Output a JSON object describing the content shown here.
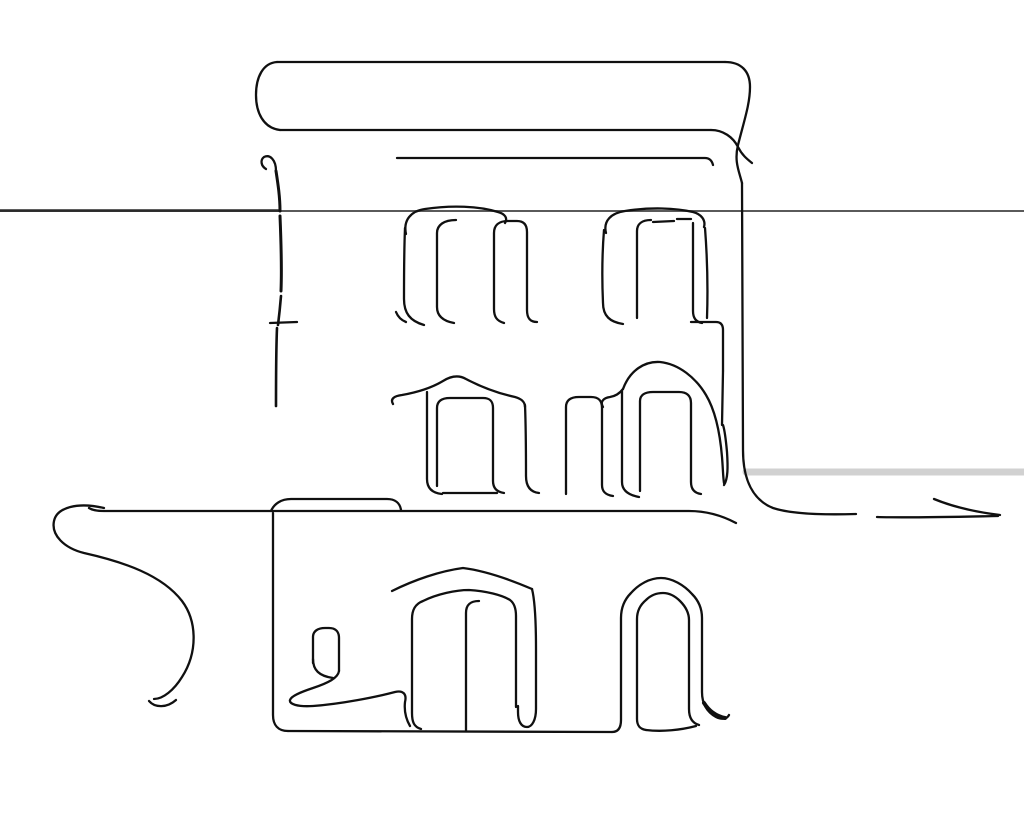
{
  "meta": {
    "subject": "continuous single-line ink sketch of a two-storey classical building with arched windows, a gabled doorway and flourish strokes",
    "background_color": "#ffffff",
    "ink_color": "#101010",
    "default_stroke_width": 2.3,
    "canvas": {
      "width": 1024,
      "height": 819
    }
  },
  "drawing": {
    "viewbox": "0 0 1024 819",
    "paths": [
      {
        "id": "horizon-line-upper",
        "d": "M 0 211 L 1024 211",
        "w": 2,
        "c": "#5a5a5a"
      },
      {
        "id": "horizon-line-upper-left",
        "d": "M 0 210.6 L 278 210.6",
        "w": 2.6,
        "c": "#2a2a2a"
      },
      {
        "id": "shadow-band-right",
        "d": "M 746 472 L 1024 472",
        "w": 7,
        "c": "#000000",
        "o": 0.18
      },
      {
        "id": "roof-top-edge",
        "d": "M 277 62 L 725 62"
      },
      {
        "id": "roof-left-cap",
        "d": "M 277 62 C 263 63 256 77 256 95 C 256 112 263 128 280 130"
      },
      {
        "id": "roof-bottom-edge",
        "d": "M 280 130 L 711 130"
      },
      {
        "id": "roof-right-cap",
        "d": "M 725 62 C 741 62 750 71 750 87 C 750 104 744 121 738 145 C 734 161 739 171 742 183"
      },
      {
        "id": "roof-bottom-right-cross",
        "d": "M 711 130 C 723 130 733 137 738 147 C 742 155 747 159 752 163"
      },
      {
        "id": "fascia-line",
        "d": "M 397 158 L 705 158 C 710 158 712 161 713 165"
      },
      {
        "id": "right-wall",
        "d": "M 742 183 L 743 450 C 743 480 753 500 773 508 C 791 514 822 515 856 514"
      },
      {
        "id": "left-wall-top-curl",
        "d": "M 276 171 C 276 160 270 154 264 157 C 260 160 261 166 266 169"
      },
      {
        "id": "left-wall-dash-1",
        "d": "M 276 171 C 278 184 280 197 280 211",
        "w": 3
      },
      {
        "id": "left-wall-dash-2",
        "d": "M 280 216 C 281 240 282 266 281 291",
        "w": 3
      },
      {
        "id": "left-wall-dash-3",
        "d": "M 281 296 C 280 308 279 317 278 325",
        "w": 2.6
      },
      {
        "id": "left-wall-dash-4",
        "d": "M 277 328 C 276 352 276 378 276 406",
        "w": 2.6
      },
      {
        "id": "left-wall-taper-tip",
        "d": "M 272.5 402 L 279.5 402 L 276 487 Z",
        "fill": true
      },
      {
        "id": "left-wall-sill-tick",
        "d": "M 270 323 L 297 322"
      },
      {
        "id": "win-up-left-arch",
        "d": "M 406 234 C 403 220 411 211 425 209 C 451 205 479 206 498 212 C 505 214 508 218 505 223"
      },
      {
        "id": "win-up-left-side",
        "d": "M 405 228 C 404 252 404 278 404 299 C 404 313 410 321 424 325"
      },
      {
        "id": "win-up-left-tick",
        "d": "M 396 312 C 398 317 401 320 406 322"
      },
      {
        "id": "win-up-left-pane-a",
        "d": "M 456 220 C 444 220 437 225 437 233 L 437 307 C 437 316 443 321 454 323"
      },
      {
        "id": "win-up-left-pane-b",
        "d": "M 504 323 C 497 321 494 317 494 309 L 494 233 C 494 225 499 221 508 221 L 517 221 C 524 221 527 225 527 232 L 527 310 C 527 318 530 322 537 322"
      },
      {
        "id": "win-up-right-arch",
        "d": "M 606 233 C 603 221 611 213 625 211 C 650 207 676 208 693 212 C 701 214 706 220 704 227"
      },
      {
        "id": "win-up-right-side",
        "d": "M 604 230 C 602 255 602 281 603 303 C 603 316 610 322 623 324"
      },
      {
        "id": "win-up-right-jamb",
        "d": "M 705 228 C 707 254 708 289 707 318"
      },
      {
        "id": "win-up-right-sill",
        "d": "M 691 322 L 716 322 C 721 322 723 325 723 330 L 723 371"
      },
      {
        "id": "win-up-right-pane-left",
        "d": "M 637 318 L 637 231 C 637 224 642 220 651 220"
      },
      {
        "id": "win-up-right-pane-top-1",
        "d": "M 653 222 L 674 221"
      },
      {
        "id": "win-up-right-pane-top-2",
        "d": "M 677 219 L 691 219"
      },
      {
        "id": "win-up-right-pane-right",
        "d": "M 693 223 L 693 311 C 693 318 696 322 702 323"
      },
      {
        "id": "win-mid-left-arch",
        "d": "M 393 404 C 390 399 394 396 402 395 C 419 392 433 387 443 381 C 451 376 459 375 466 379 C 485 389 501 394 515 397 C 522 399 525 402 525 407"
      },
      {
        "id": "win-mid-left-side",
        "d": "M 427 392 L 427 479 C 427 488 432 493 442 494"
      },
      {
        "id": "win-mid-left-right-side",
        "d": "M 525 405 C 526 430 526 454 526 476 C 526 486 530 492 539 493"
      },
      {
        "id": "win-mid-left-pane",
        "d": "M 437 486 L 437 408 C 437 401 442 398 450 398 L 483 398 C 490 398 493 401 493 408 L 493 481 C 493 488 497 492 504 493"
      },
      {
        "id": "win-mid-left-pane-bottom",
        "d": "M 443 493 L 497 493"
      },
      {
        "id": "win-mid-center-pane",
        "d": "M 566 494 L 566 407 C 566 400 571 397 579 397 L 591 397 C 599 397 602 401 602 408 L 602 485 C 602 492 606 495 613 496"
      },
      {
        "id": "win-mid-right-start-curl",
        "d": "M 603 407 C 600 402 603 398 610 397 C 616 396 620 393 623 389"
      },
      {
        "id": "win-mid-right-arch",
        "d": "M 623 389 C 630 370 645 361 660 362 C 679 364 696 378 706 395 C 715 410 720 433 722 457 C 723 469 723 477 724 483"
      },
      {
        "id": "win-mid-right-leaf",
        "d": "M 724 485 C 728 479 728 467 727 452 C 726 441 725 431 723 425"
      },
      {
        "id": "win-mid-right-jamb",
        "d": "M 723 371 L 722 425"
      },
      {
        "id": "win-mid-right-side",
        "d": "M 622 391 L 622 482 C 622 490 628 495 639 497"
      },
      {
        "id": "win-mid-right-pane",
        "d": "M 640 491 L 640 401 C 640 395 645 392 653 392 L 679 392 C 687 392 691 396 691 403 L 691 482 C 691 489 694 493 701 494"
      },
      {
        "id": "ground-line",
        "d": "M 89 508 C 92 510 97 511 104 511 L 689 511 C 705 511 721 515 736 523"
      },
      {
        "id": "porch-ledge",
        "d": "M 271 511 C 274 504 281 499 291 499 L 387 499 C 395 499 400 503 401 510"
      },
      {
        "id": "porch-left-post",
        "d": "M 273 513 L 273 715 C 273 725 278 731 288 731"
      },
      {
        "id": "base-line",
        "d": "M 288 731 L 612 732"
      },
      {
        "id": "flourish-s-curve",
        "d": "M 104 508 C 78 502 57 507 54 521 C 51 535 64 548 84 553 C 124 562 162 575 182 601 C 197 621 198 652 182 677 C 174 690 163 699 154 699"
      },
      {
        "id": "flourish-tail-flick",
        "d": "M 149 701 C 155 708 167 708 176 700"
      },
      {
        "id": "steps-pane",
        "d": "M 313 663 L 313 637 C 313 631 318 628 325 628 L 329 628 C 336 628 339 632 339 638 L 339 671"
      },
      {
        "id": "steps-pane-foot",
        "d": "M 313 659 C 313 670 319 676 333 678"
      },
      {
        "id": "steps-swoosh",
        "d": "M 339 671 C 338 678 328 683 313 688 C 301 692 291 696 290 700 C 289 704 297 707 313 706 C 341 704 376 697 395 692 C 403 690 407 694 405 702 C 404 711 406 719 410 726"
      },
      {
        "id": "door-left-gable",
        "d": "M 392 591 C 414 580 440 571 463 568 C 487 571 511 580 532 589"
      },
      {
        "id": "door-left-gable-side",
        "d": "M 532 589 C 535 601 536 621 536 649 L 536 709 C 536 720 532 727 527 727 C 521 727 518 721 518 712 L 518 706"
      },
      {
        "id": "door-left-frame",
        "d": "M 421 729 C 414 727 412 722 412 713 L 412 619 C 412 610 415 604 423 601 C 437 594 456 590 469 590 C 486 591 502 595 510 600 C 514 603 516 609 516 616 L 516 707"
      },
      {
        "id": "door-left-mullion",
        "d": "M 479 601 C 470 601 466 605 466 613 L 466 731"
      },
      {
        "id": "door-right-frame",
        "d": "M 612 732 C 618 732 621 728 621 720 L 621 618 C 621 608 624 600 631 593 C 639 584 650 578 661 578 C 672 578 684 585 692 594 C 699 601 702 609 702 618 L 702 692 C 702 704 707 712 716 717 C 722 720 727 719 729 715"
      },
      {
        "id": "door-right-foot-thick",
        "d": "M 704 703 C 709 711 716 716 725 718",
        "w": 4
      },
      {
        "id": "door-right-inner",
        "d": "M 646 730 C 640 729 637 726 637 719 L 637 619 C 637 611 640 605 646 600 C 651 595 657 593 663 593 C 669 593 675 596 680 601 C 686 607 689 613 689 620 L 689 709 C 689 717 692 723 699 725"
      },
      {
        "id": "door-right-inner-bottom",
        "d": "M 646 730 C 662 732 681 730 696 726"
      },
      {
        "id": "ground-right-segment",
        "d": "M 877 517 C 906 518 947 517 998 516"
      },
      {
        "id": "ground-right-flick",
        "d": "M 934 499 C 951 506 975 512 1000 515"
      }
    ]
  }
}
